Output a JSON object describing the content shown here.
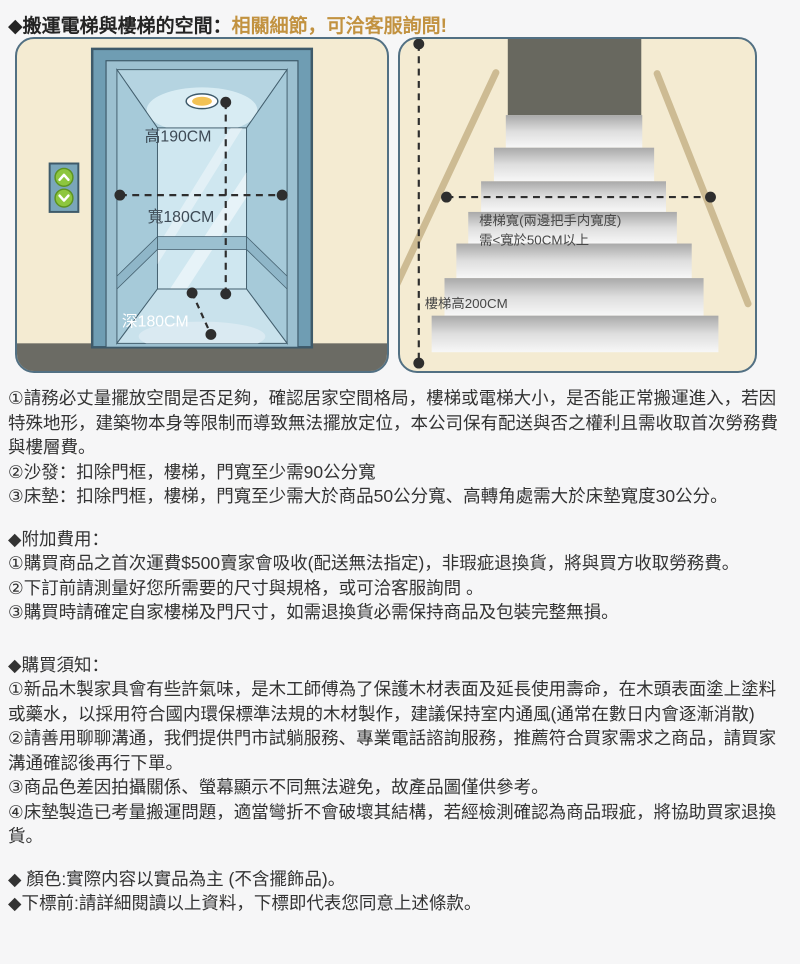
{
  "page": {
    "background": "#f6f6f7"
  },
  "header": {
    "prefix": "◆搬運電梯與樓梯的空間：",
    "highlight": "相關細節，可洽客服詢問!",
    "highlight_color": "#c29240"
  },
  "panels": {
    "background": "#f4ebd2",
    "border_color": "#527083",
    "elevator": {
      "height_label": "高190CM",
      "width_label": "寬180CM",
      "depth_label": "深180CM"
    },
    "stairs": {
      "width_label_line1": "樓梯寬(兩邊把手内寬度)",
      "width_label_line2": "需<寬於50CM以上",
      "height_label": "樓梯高200CM"
    }
  },
  "space_requirements": {
    "items": [
      "①請務必丈量擺放空間是否足夠，確認居家空間格局，樓梯或電梯大小，是否能正常搬運進入，若因特殊地形，建築物本身等限制而導致無法擺放定位，本公司保有配送與否之權利且需收取首次勞務費與樓層費。",
      "②沙發：扣除門框，樓梯，門寬至少需90公分寬",
      "③床墊：扣除門框，樓梯，門寬至少需大於商品50公分寬、高轉角處需大於床墊寬度30公分。"
    ]
  },
  "additional_fees": {
    "title": "◆附加費用：",
    "items": [
      "①購買商品之首次運費$500賣家會吸收(配送無法指定)，非瑕疵退換貨，將與買方收取勞務費。",
      "②下訂前請測量好您所需要的尺寸與規格，或可洽客服詢問 。",
      "③購買時請確定自家樓梯及門尺寸，如需退換貨必需保持商品及包裝完整無損。"
    ]
  },
  "purchase_notes": {
    "title": "◆購買須知：",
    "items": [
      "①新品木製家具會有些許氣味，是木工師傅為了保護木材表面及延長使用壽命，在木頭表面塗上塗料或藥水，以採用符合國内環保標準法規的木材製作，建議保持室内通風(通常在數日内會逐漸消散)",
      "②請善用聊聊溝通，我們提供門市試躺服務、專業電話諮詢服務，推薦符合買家需求之商品，請買家溝通確認後再行下單。",
      "③商品色差因拍攝關係、螢幕顯示不同無法避免，故產品圖僅供參考。",
      "④床墊製造已考量搬運問題，適當彎折不會破壞其結構，若經檢測確認為商品瑕疵，將協助買家退換貨。"
    ]
  },
  "footer_notes": {
    "color_note": "◆ 顏色:實際内容以實品為主 (不含擺飾品)。",
    "order_note": "◆下標前:請詳細閱讀以上資料，下標即代表您同意上述條款。"
  }
}
